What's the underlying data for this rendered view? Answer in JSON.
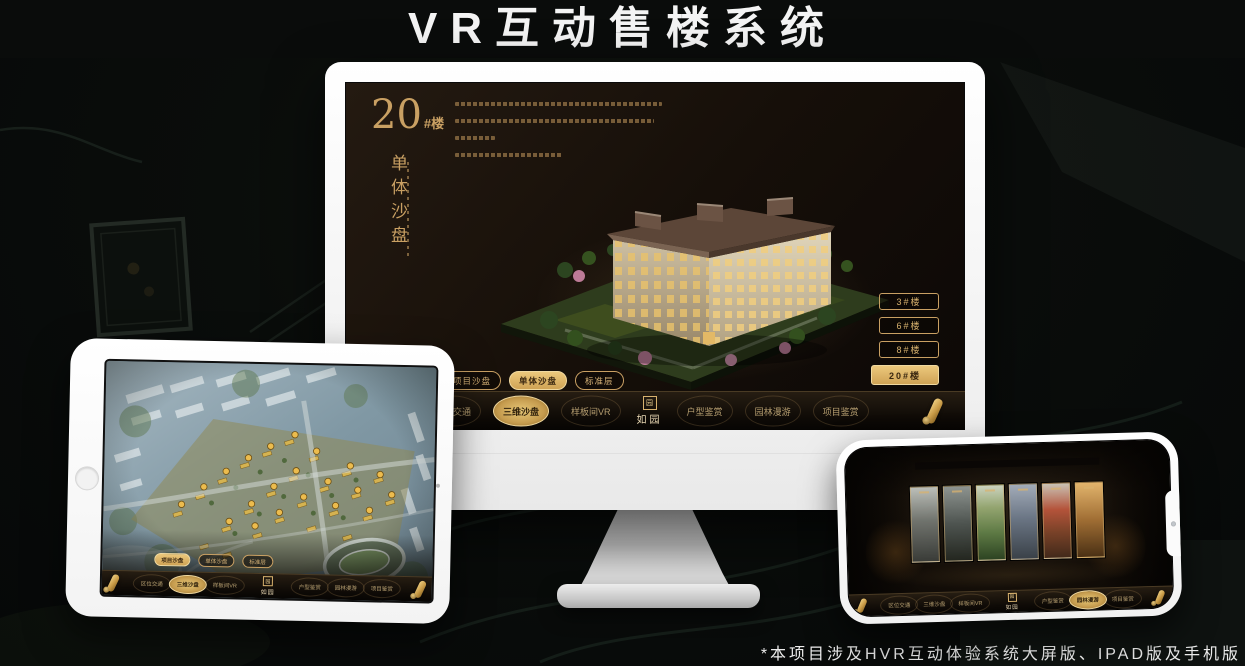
{
  "title": "VR互动售楼系统",
  "footnote": "*本项目涉及HVR互动体验系统大屏版、IPAD版及手机版",
  "brand": {
    "logo_text": "如园",
    "seal_char": "园",
    "gold": "#c9a063",
    "gold_active": "#e0b468"
  },
  "monitor": {
    "unit_number": "20",
    "unit_suffix": "#楼",
    "section_title_vertical": "单体沙盘",
    "floor_buttons": [
      {
        "label": "3#楼",
        "active": false
      },
      {
        "label": "6#楼",
        "active": false
      },
      {
        "label": "8#楼",
        "active": false
      },
      {
        "label": "20#楼",
        "active": true
      }
    ],
    "tabs": [
      {
        "label": "项目沙盘",
        "active": false
      },
      {
        "label": "单体沙盘",
        "active": true
      },
      {
        "label": "标准层",
        "active": false
      }
    ],
    "nav_left": [
      {
        "label": "区位交通",
        "active": false
      },
      {
        "label": "三维沙盘",
        "active": true
      },
      {
        "label": "样板间VR",
        "active": false
      }
    ],
    "nav_right": [
      {
        "label": "户型鉴赏",
        "active": false
      },
      {
        "label": "园林漫游",
        "active": false
      },
      {
        "label": "项目鉴赏",
        "active": false
      }
    ]
  },
  "tablet": {
    "tabs": [
      {
        "label": "项目沙盘",
        "active": true
      },
      {
        "label": "单体沙盘",
        "active": false
      },
      {
        "label": "标准层",
        "active": false
      }
    ],
    "nav_left": [
      {
        "label": "区位交通",
        "active": false
      },
      {
        "label": "三维沙盘",
        "active": true
      },
      {
        "label": "样板间VR",
        "active": false
      }
    ],
    "nav_right": [
      {
        "label": "户型鉴赏",
        "active": false
      },
      {
        "label": "园林漫游",
        "active": false
      },
      {
        "label": "项目鉴赏",
        "active": false
      }
    ]
  },
  "phone": {
    "nav_left": [
      {
        "label": "区位交通",
        "active": false
      },
      {
        "label": "三维沙盘",
        "active": false
      },
      {
        "label": "样板间VR",
        "active": false
      }
    ],
    "nav_right": [
      {
        "label": "户型鉴赏",
        "active": false
      },
      {
        "label": "园林漫游",
        "active": true
      },
      {
        "label": "项目鉴赏",
        "active": false
      }
    ],
    "gallery_panels": [
      "p1",
      "p2",
      "p3",
      "p4",
      "p5",
      "p6"
    ]
  }
}
